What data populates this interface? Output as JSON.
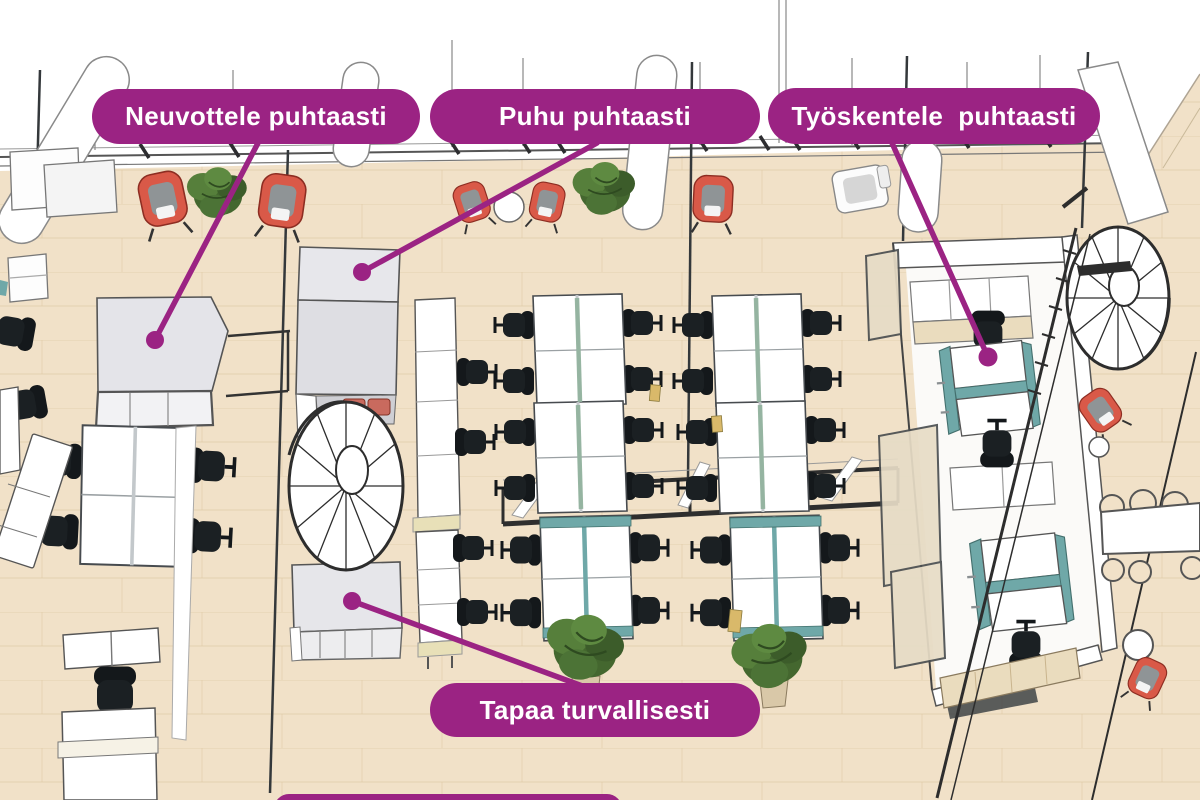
{
  "image_type": "annotated isometric office floor plan",
  "language": "Finnish",
  "callouts": [
    {
      "id": "neuvottele",
      "text": "Neuvottele puhtaasti"
    },
    {
      "id": "puhu",
      "text": "Puhu puhtaasti"
    },
    {
      "id": "tyoskentele",
      "text": "Työskentele  puhtaasti"
    },
    {
      "id": "tapaa",
      "text": "Tapaa turvallisesti"
    },
    {
      "id": "bottom-partial",
      "text": ""
    }
  ],
  "colors": {
    "callout_bg": "#9B2383",
    "callout_text": "#FFFFFF",
    "leader_line": "#9B2383",
    "floor": "#F1E1C8",
    "floor_seam": "#DEC7A3",
    "outline": "#44484B",
    "pod_roof_grey": "#E4E4E9",
    "chair_black": "#1B2023",
    "divider_teal": "#6FA8A8",
    "divider_sage": "#93B39F",
    "accent_red": "#D95948",
    "plant_green": "#4C7337",
    "wood_accent": "#EADCBE",
    "cabinet_strip": "#E8E0B8",
    "glass_tint": "#E7DCC6"
  },
  "scene_objects": [
    "meeting-pod-large",
    "phone-booth",
    "meeting-pod-small",
    "team-room",
    "spiral-staircase-left",
    "spiral-staircase-right",
    "desk-cluster",
    "storage-cabinets",
    "glass-partition",
    "plant",
    "red-chair",
    "lounge-armchair",
    "round-table",
    "stool",
    "long-table",
    "railing",
    "reception-desk",
    "shelf-unit"
  ]
}
